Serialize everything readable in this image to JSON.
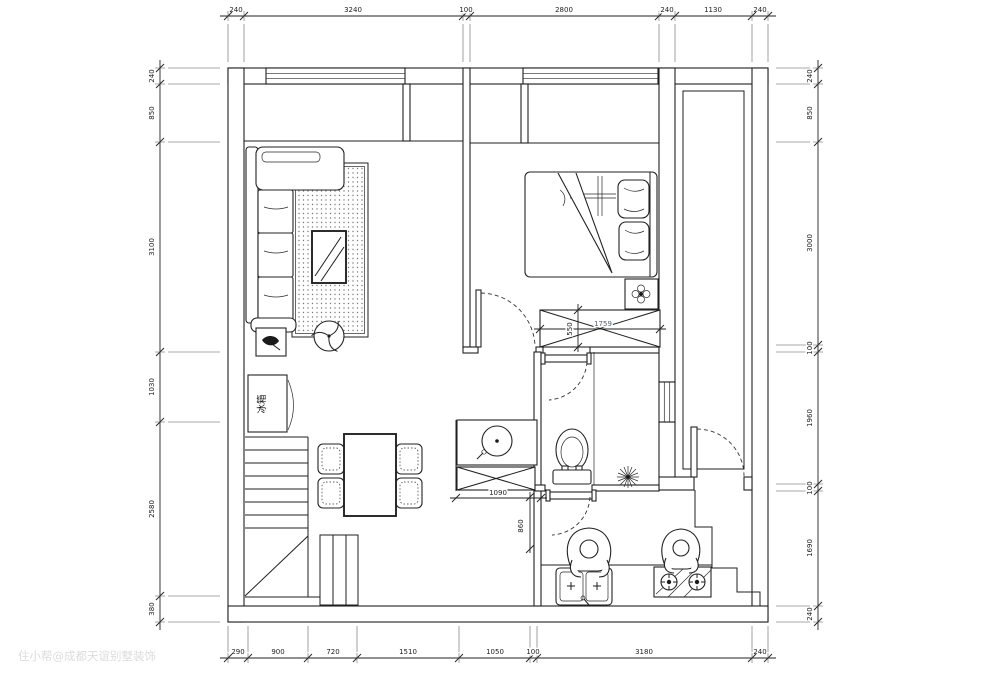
{
  "watermark": {
    "text": "住小帮@成都天谊别墅装饰",
    "color": "#dcdcdc"
  },
  "dimensions": {
    "top": [
      "240",
      "3240",
      "100",
      "2800",
      "240",
      "1130",
      "240"
    ],
    "bottom": [
      "290",
      "900",
      "720",
      "1510",
      "1050",
      "100",
      "3180",
      "240"
    ],
    "left": [
      "240",
      "850",
      "3100",
      "1030",
      "2580",
      "380"
    ],
    "right": [
      "240",
      "850",
      "3000",
      "100",
      "1960",
      "100",
      "1690",
      "240"
    ]
  },
  "interior_dimensions": {
    "wardrobe_width": "1759",
    "wardrobe_depth": "550",
    "cabinet_width": "1090",
    "kitchen_passage": "860"
  },
  "labels": {
    "fridge": "冰箱"
  },
  "colors": {
    "line": "#1f1f1f",
    "dim_text": "#1d1d1d",
    "wardrobe_dim_text": "#4a6478",
    "watermark": "#dcdcdc",
    "background": "#ffffff"
  }
}
